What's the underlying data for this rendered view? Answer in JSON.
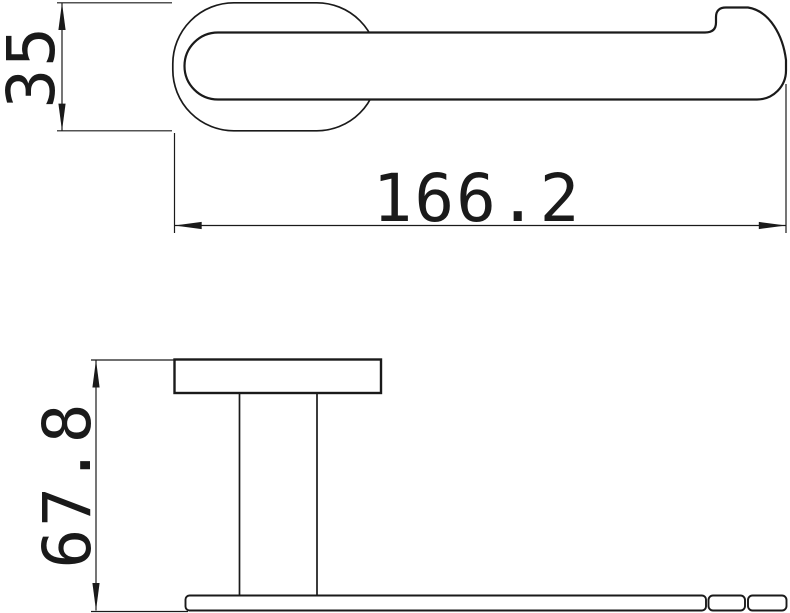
{
  "colors": {
    "background": "#ffffff",
    "line": "#1a1a1a"
  },
  "views": {
    "top": {
      "height_dim": {
        "value": "35"
      },
      "length_dim": {
        "value": "166.2"
      }
    },
    "side": {
      "depth_dim": {
        "value": "67.8"
      }
    }
  }
}
